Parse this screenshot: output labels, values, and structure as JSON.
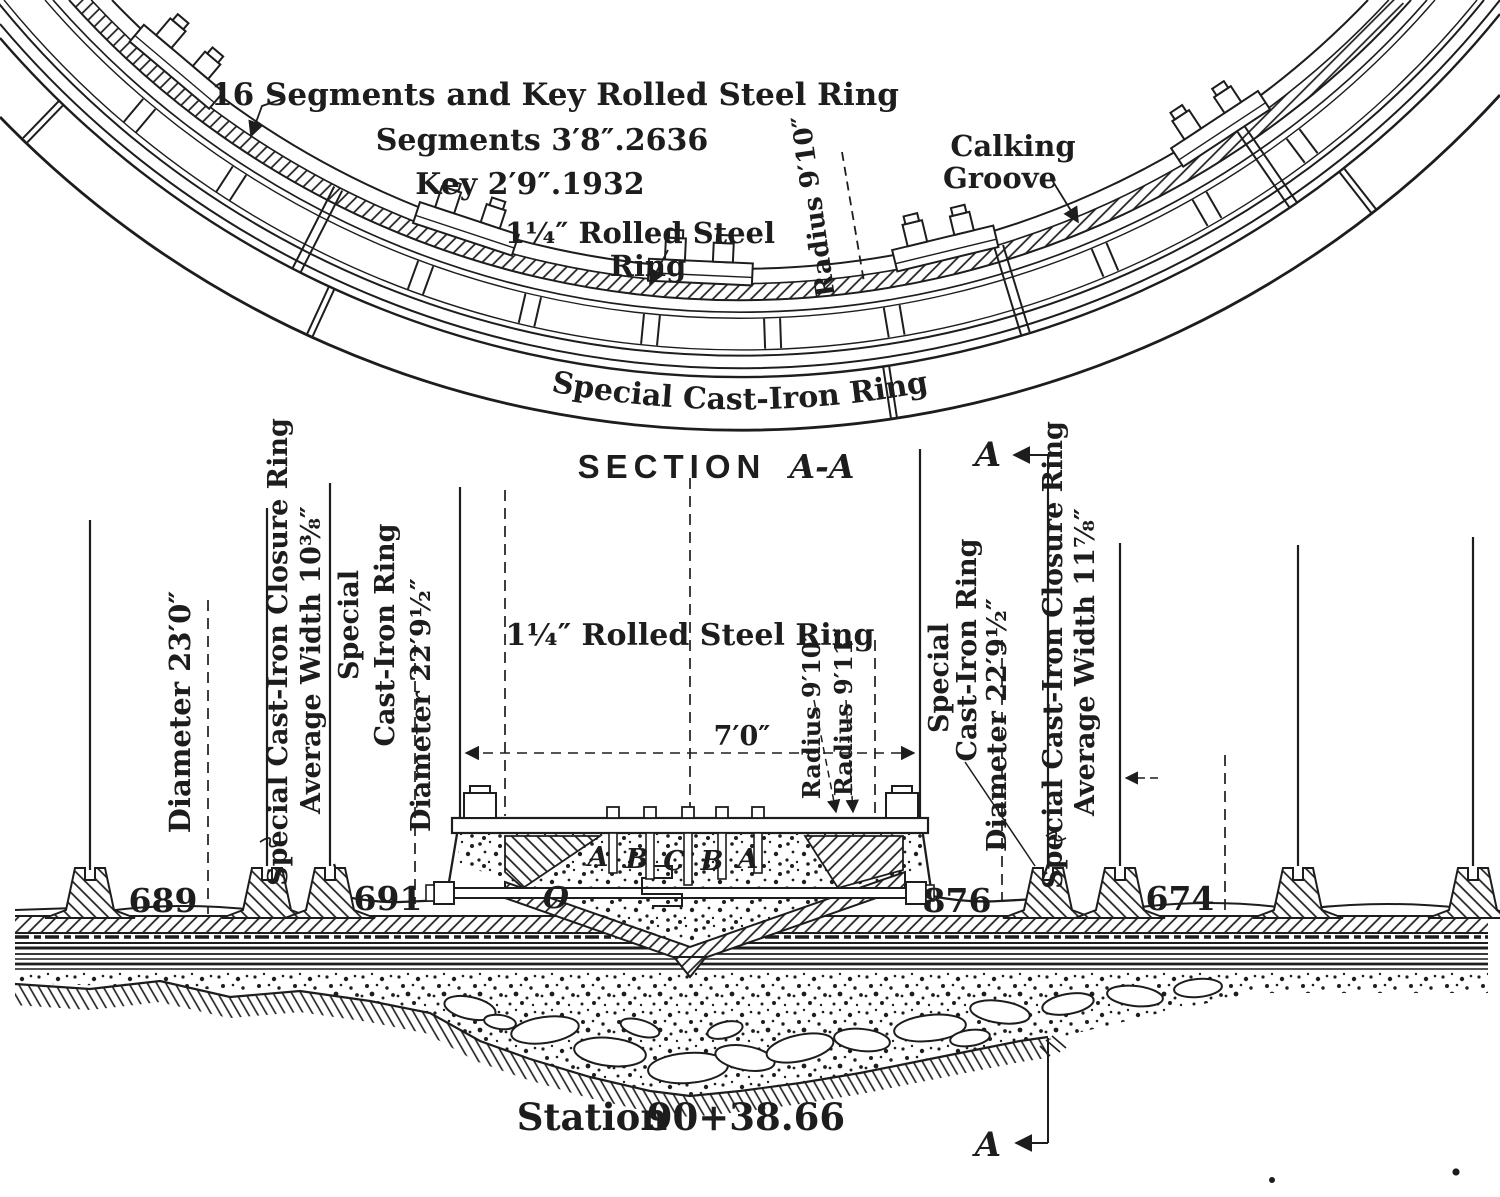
{
  "colors": {
    "ink": "#1d1d1d",
    "paper": "#ffffff"
  },
  "plan_view": {
    "segments_note_line1": "16 Segments and Key Rolled Steel Ring",
    "segments_note_line2": "Segments 3′8″.2636",
    "segments_note_line3": "Key 2′9″.1932",
    "rolled_steel_ring_line1": "1¼″ Rolled Steel",
    "rolled_steel_ring_line2": "Ring",
    "radius_label": "Radius 9′10″",
    "calking_line1": "Calking",
    "calking_line2": "Groove",
    "cast_iron_ring_band": "Special Cast-Iron Ring"
  },
  "section_title": {
    "word": "SECTION",
    "cut": "A-A"
  },
  "section_view": {
    "rolled_steel_ring": "1¼″ Rolled Steel Ring",
    "width_dim": "7′0″",
    "radius_inner": "Radius 9′10″",
    "radius_outer": "Radius 9′11″",
    "left_labels": {
      "diameter": "Diameter 23′0″",
      "closure_line1": "Special Cast-Iron Closure Ring",
      "closure_line2": "Average Width 10⅜″",
      "special_line1": "Special",
      "special_line2": "Cast-Iron Ring",
      "special_line3": "Diameter 22′9½″"
    },
    "right_labels": {
      "special_line1": "Special",
      "special_line2": "Cast-Iron Ring",
      "special_line3": "Diameter 22′9½″",
      "closure_line1": "Special Cast-Iron Closure Ring",
      "closure_line2": "Average Width 11⅞″"
    },
    "ring_numbers": [
      "689",
      "691",
      "876",
      "674"
    ],
    "grout_letters": [
      "A",
      "B",
      "C",
      "B",
      "A"
    ],
    "origin_letter": "O",
    "section_marker": "A",
    "station_label": "Station",
    "station_value": "90+38.66"
  }
}
